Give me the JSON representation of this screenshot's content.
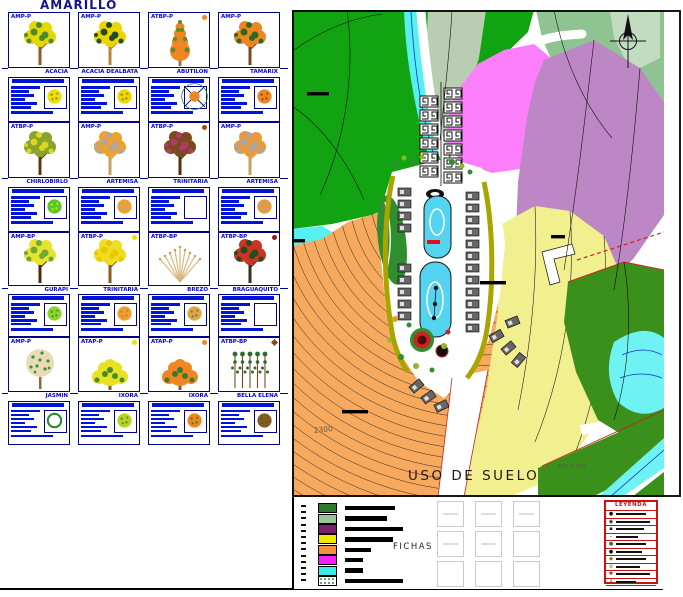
{
  "title": "AMARILLO",
  "catalog": {
    "cards": [
      {
        "code": "AMP-P",
        "name": "ACACIA",
        "dot": null,
        "tree": {
          "type": "tree",
          "c1": "#e3d800",
          "c2": "#4a8a2a",
          "trunk": "#8a5a2a"
        },
        "plan": {
          "type": "circle",
          "color": "#e8e000",
          "speckle": "#8a8a00"
        }
      },
      {
        "code": "AMP-P",
        "name": "ACACIA DEALBATA",
        "dot": null,
        "tree": {
          "type": "tree",
          "c1": "#f0d400",
          "c2": "#1e4d1e",
          "trunk": "#b5853f"
        },
        "plan": {
          "type": "circle",
          "color": "#f0d400",
          "speckle": "#8a8a00"
        }
      },
      {
        "code": "ATBP-P",
        "name": "ABUTILON",
        "dot": {
          "color": "#f08622",
          "shape": "circle"
        },
        "tree": {
          "type": "cone",
          "c1": "#f08622",
          "c2": "#5a8a2a",
          "trunk": "#9a7a4a"
        },
        "plan": {
          "type": "cross",
          "color": "#f08622"
        }
      },
      {
        "code": "AMP-P",
        "name": "TAMARIX",
        "dot": null,
        "tree": {
          "type": "tree",
          "c1": "#f08622",
          "c2": "#2d6a1e",
          "trunk": "#7a4a1e"
        },
        "plan": {
          "type": "circle",
          "color": "#f08622",
          "speckle": "#7a4a1e"
        }
      },
      {
        "code": "ATBP-P",
        "name": "CHIRLOBIRLO",
        "dot": null,
        "tree": {
          "type": "tree",
          "c1": "#8aa32d",
          "c2": "#d8d822",
          "trunk": "#5a381a"
        },
        "plan": {
          "type": "circle",
          "color": "#58c828",
          "speckle": "#e8e000"
        }
      },
      {
        "code": "AMP-P",
        "name": "ARTEMISA",
        "dot": null,
        "tree": {
          "type": "tree",
          "c1": "#f0a02d",
          "c2": "#a8a8a8",
          "trunk": "#c8a060"
        },
        "plan": {
          "type": "circle",
          "color": "#f0a02d",
          "speckle": "#a8a8a8"
        }
      },
      {
        "code": "ATBP-P",
        "name": "TRINITARIA",
        "dot": {
          "color": "#a34a0f",
          "shape": "circle"
        },
        "tree": {
          "type": "tree",
          "c1": "#7a4a1e",
          "c2": "#b03a6a",
          "trunk": "#5a2d0f"
        },
        "plan": {
          "type": "empty",
          "color": "#ffffff"
        }
      },
      {
        "code": "AMP-P",
        "name": "ARTEMISA",
        "dot": null,
        "tree": {
          "type": "tree",
          "c1": "#e89a3a",
          "c2": "#a8a8a8",
          "trunk": "#c8a060"
        },
        "plan": {
          "type": "circle",
          "color": "#e89a3a",
          "speckle": "#a8a8a8"
        }
      },
      {
        "code": "AMP-BP",
        "name": "GURAPI",
        "dot": null,
        "tree": {
          "type": "tree",
          "c1": "#e8e32d",
          "c2": "#6aaa3a",
          "trunk": "#4a2d0f"
        },
        "plan": {
          "type": "circle",
          "color": "#8ad52d",
          "speckle": "#4a8a2a"
        }
      },
      {
        "code": "ATBP-P",
        "name": "TRINITARIA",
        "dot": {
          "color": "#f0e000",
          "shape": "circle"
        },
        "tree": {
          "type": "tree",
          "c1": "#f0dd22",
          "c2": "#e8c800",
          "trunk": "#8a5a1e"
        },
        "plan": {
          "type": "circle",
          "color": "#f0a02d",
          "speckle": "#c87a1e"
        }
      },
      {
        "code": "ATBP-BP",
        "name": "BREZO",
        "dot": null,
        "tree": {
          "type": "fan",
          "c1": "#d8b87a",
          "c2": "#c8a35a",
          "trunk": "#b5935a"
        },
        "plan": {
          "type": "circle",
          "color": "#d8a84a",
          "speckle": "#8a6a2a"
        }
      },
      {
        "code": "ATBP-BP",
        "name": "BRAGUAQUITO",
        "dot": {
          "color": "#8a1e0f",
          "shape": "circle"
        },
        "tree": {
          "type": "tree",
          "c1": "#cc3322",
          "c2": "#1e4d1e",
          "trunk": "#3a2d1e"
        },
        "plan": {
          "type": "empty",
          "color": "#ffffff"
        }
      },
      {
        "code": "AMP-P",
        "name": "JASMIN",
        "dot": null,
        "tree": {
          "type": "round",
          "c1": "#e8dcb5",
          "c2": "#4a8a3a",
          "trunk": "#8a6a3a"
        },
        "plan": {
          "type": "ring",
          "color": "#2d8a2d"
        }
      },
      {
        "code": "ATAP-P",
        "name": "IXORA",
        "dot": {
          "color": "#f0e000",
          "shape": "circle"
        },
        "tree": {
          "type": "shrub",
          "c1": "#e8e022",
          "c2": "#4a8a2a",
          "trunk": "#8a5a2a"
        },
        "plan": {
          "type": "circle",
          "color": "#b5d522",
          "speckle": "#4a8a2a"
        }
      },
      {
        "code": "ATAP-P",
        "name": "IXORA",
        "dot": {
          "color": "#f08622",
          "shape": "circle"
        },
        "tree": {
          "type": "shrub",
          "c1": "#f08622",
          "c2": "#3a7a2a",
          "trunk": "#8a5a2a"
        },
        "plan": {
          "type": "circle",
          "color": "#f08622",
          "speckle": "#3a7a2a"
        }
      },
      {
        "code": "ATBP-BP",
        "name": "BELLA ELENA",
        "dot": {
          "color": "#8a4a1e",
          "shape": "diamond"
        },
        "tree": {
          "type": "stalks",
          "c1": "#2d6a2d",
          "c2": "#7a4a1e",
          "trunk": "#7a4a1e"
        },
        "plan": {
          "type": "circle",
          "color": "#8a5a1e",
          "speckle": "#2d6a2d"
        }
      }
    ]
  },
  "map": {
    "labels": {
      "land_use": "USO DE SUELO",
      "scale": "ESC. 1:500",
      "contour": "2300"
    },
    "colors": {
      "dark_green": "#12a312",
      "sage": "#b9cdb3",
      "medium_green": "#8fc492",
      "light_green": "#c2dcc0",
      "pink": "#fb7ffb",
      "purple": "#bd86c4",
      "orange": "#f7a95e",
      "yellow": "#f2ef8f",
      "dark_green_2": "#3b8f1b",
      "cyan": "#57f0f0",
      "pool": "#55d4f2",
      "olive": "#a8a400",
      "red": "#cc2222"
    }
  },
  "bottom": {
    "fichas_label": "FICHAS",
    "swatches": [
      {
        "color": "#2d7a2d",
        "bar": 50
      },
      {
        "color": "#9cc49c",
        "bar": 42
      },
      {
        "color": "#7a1f6e",
        "bar": 58
      },
      {
        "color": "#f5e800",
        "bar": 48
      },
      {
        "color": "#f5913e",
        "bar": 26
      },
      {
        "color": "#f520f5",
        "bar": 18
      },
      {
        "color": "#40e8e8",
        "bar": 18
      },
      {
        "color": "speckled",
        "bar": 58
      }
    ],
    "ficha_boxes": [
      1,
      1,
      1,
      1,
      1,
      0,
      0,
      0,
      0
    ],
    "leyenda": {
      "title": "LEYENDA",
      "rows": [
        {
          "icon": "●",
          "color": "#111111",
          "bar": 30
        },
        {
          "icon": "◉",
          "color": "#111111",
          "bar": 34
        },
        {
          "icon": "▪",
          "color": "#111111",
          "bar": 28
        },
        {
          "icon": "–",
          "color": "#111111",
          "bar": 22
        },
        {
          "icon": "●",
          "color": "#1f7a1f",
          "bar": 30
        },
        {
          "icon": "●",
          "color": "#111111",
          "bar": 26
        },
        {
          "icon": "◆",
          "color": "#8a6a00",
          "bar": 30
        },
        {
          "icon": "✿",
          "color": "#b8a000",
          "bar": 24
        },
        {
          "icon": "✱",
          "color": "#cc1111",
          "bar": 34
        },
        {
          "icon": "↟",
          "color": "#1f7a1f",
          "bar": 20
        }
      ]
    }
  }
}
